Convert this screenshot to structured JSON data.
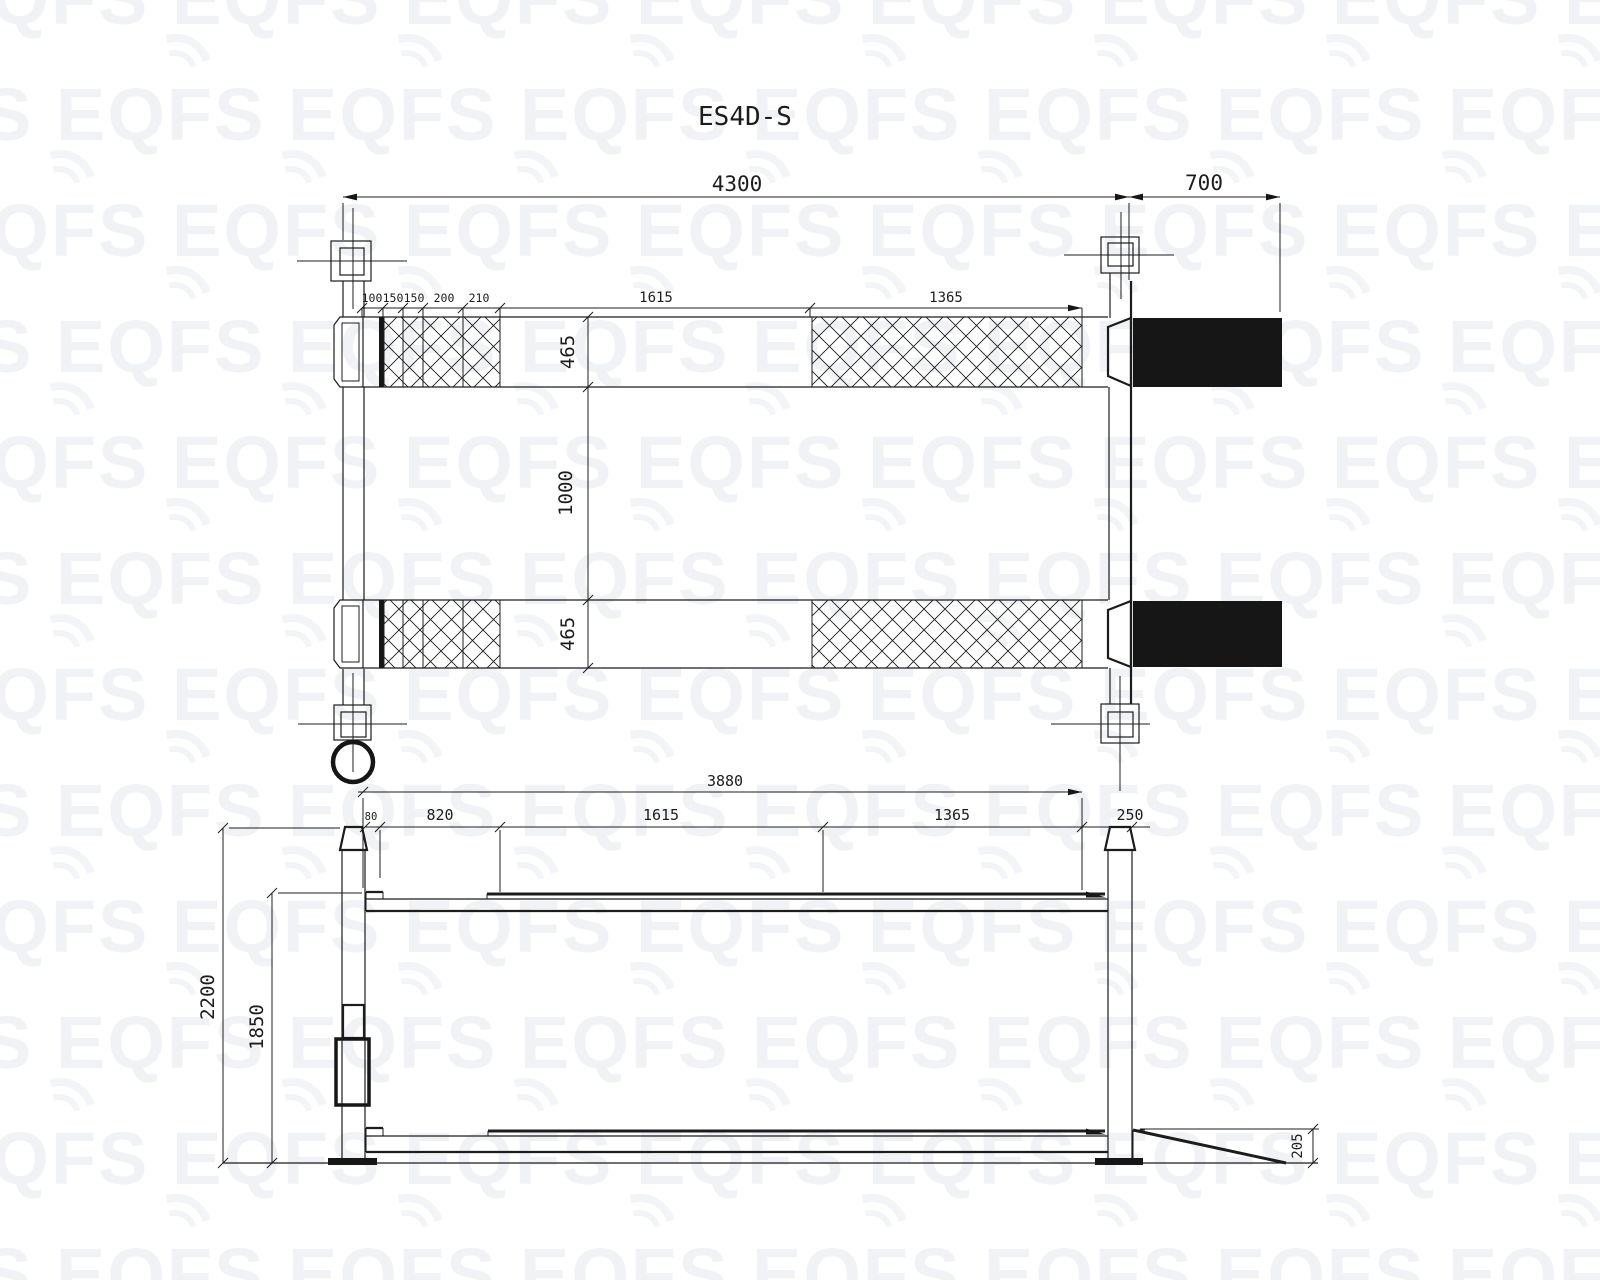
{
  "title": "ES4D-S",
  "watermark": {
    "text": "EQFS",
    "color": "#f1f2f5"
  },
  "top_view": {
    "overall_length": "4300",
    "rear_ramp_length": "700",
    "segments": {
      "a": "100",
      "b": "150",
      "c": "150",
      "d": "200",
      "e": "210",
      "f": "1615",
      "g": "1365"
    },
    "platform_width_front": "465",
    "inner_track_width": "1000",
    "platform_width_rear": "465"
  },
  "side_view": {
    "platform_length": "3880",
    "segments": {
      "a": "80",
      "b": "820",
      "c": "1615",
      "d": "1365",
      "e": "250"
    },
    "overall_height": "2200",
    "lift_height": "1850",
    "ramp_height": "205"
  }
}
